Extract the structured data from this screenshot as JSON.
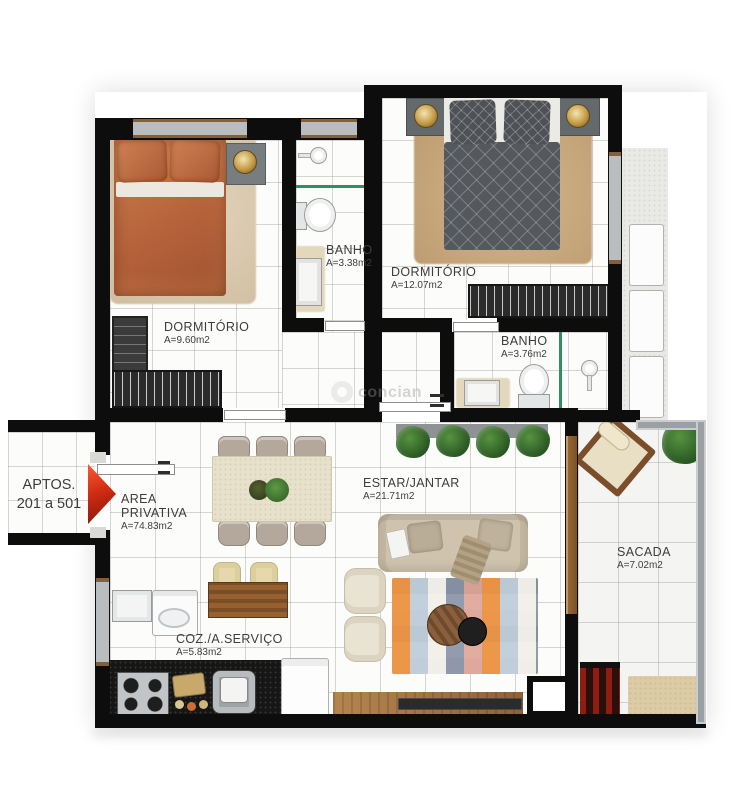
{
  "watermark": "concian",
  "entrance_sign": {
    "line1": "APTOS.",
    "line2": "201 a 501"
  },
  "rooms": {
    "dormitorio_1": {
      "name": "DORMITÓRIO",
      "area": "A=9.60m2"
    },
    "banho_1": {
      "name": "BANHO",
      "area": "A=3.38m2"
    },
    "dormitorio_2": {
      "name": "DORMITÓRIO",
      "area": "A=12.07m2"
    },
    "banho_2": {
      "name": "BANHO",
      "area": "A=3.76m2"
    },
    "area_privativa": {
      "name": "AREA PRIVATIVA",
      "area": "A=74.83m2"
    },
    "estar_jantar": {
      "name": "ESTAR/JANTAR",
      "area": "A=21.71m2"
    },
    "sacada": {
      "name": "SACADA",
      "area": "A=7.02m2"
    },
    "coz_servico": {
      "name": "COZ./A.SERVIÇO",
      "area": "A=5.83m2"
    }
  },
  "colors": {
    "wall": "#0d0d0d",
    "label_text": "#3d3d3d",
    "entrance_arrow_red": "#d12c12",
    "bed1_orange": "#b96a41",
    "bed2_gray": "#585c61",
    "rug_tan": "#c9a981",
    "sofa_beige": "#cfc4b0",
    "wood": "#9a6a3c",
    "plant_green": "#2f6d33",
    "glass_green": "#2f8f63",
    "counter_black": "#161616",
    "railing_gray": "#9aa0a4"
  }
}
